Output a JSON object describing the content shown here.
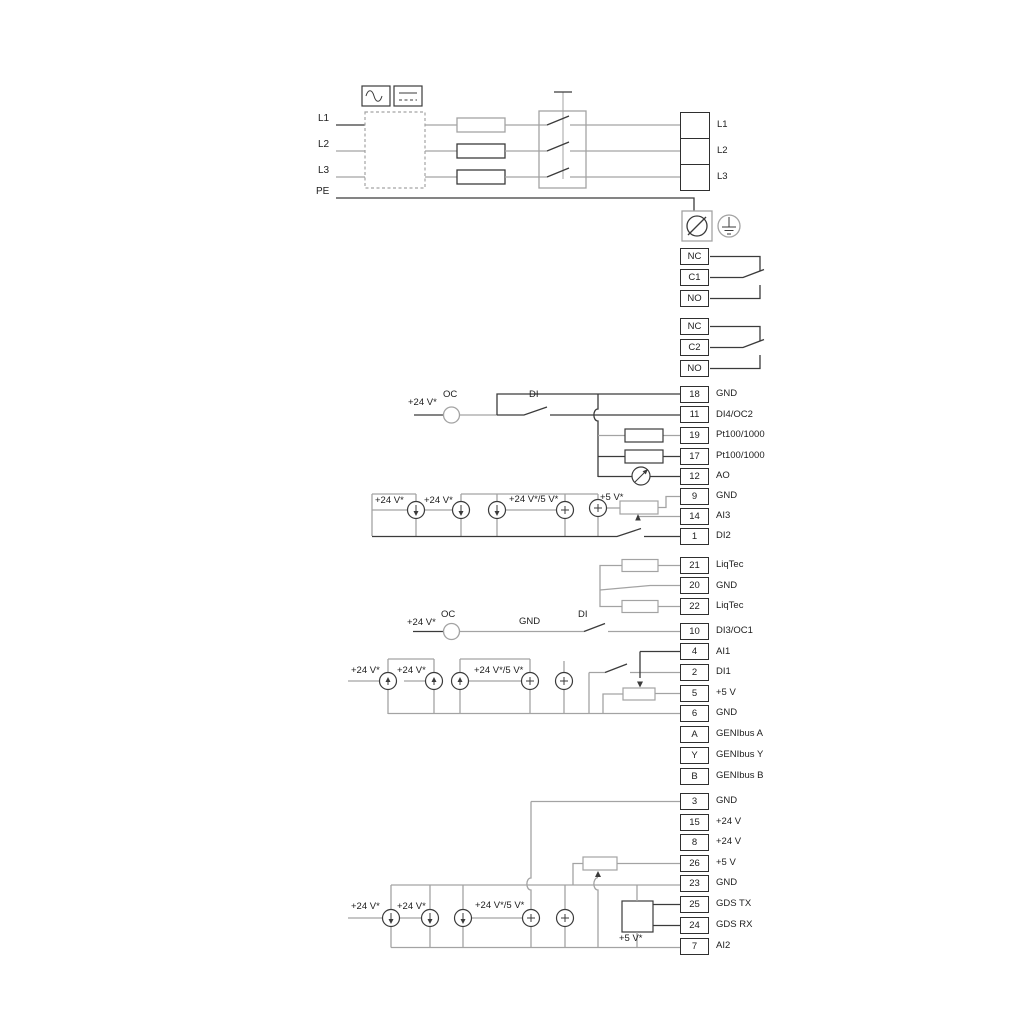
{
  "colors": {
    "background": "#ffffff",
    "wire_dark": "#3b3b3b",
    "wire_gray": "#a3a3a3",
    "text": "#1d1d1d"
  },
  "labels": {
    "v24": "+24 V*",
    "v24_5": "+24 V*/5 V*",
    "v5": "+5 V*",
    "oc": "OC",
    "di": "DI",
    "gnd": "GND"
  },
  "mains_left": [
    "L1",
    "L2",
    "L3",
    "PE"
  ],
  "mains_right": [
    "L1",
    "L2",
    "L3"
  ],
  "relay1": [
    "NC",
    "C1",
    "NO"
  ],
  "relay2": [
    "NC",
    "C2",
    "NO"
  ],
  "blocks": {
    "io1": [
      {
        "num": "18",
        "label": "GND"
      },
      {
        "num": "11",
        "label": "DI4/OC2"
      },
      {
        "num": "19",
        "label": "Pt100/1000"
      },
      {
        "num": "17",
        "label": "Pt100/1000"
      },
      {
        "num": "12",
        "label": "AO"
      },
      {
        "num": "9",
        "label": "GND"
      },
      {
        "num": "14",
        "label": "AI3"
      },
      {
        "num": "1",
        "label": "DI2"
      }
    ],
    "liqtec": [
      {
        "num": "21",
        "label": "LiqTec"
      },
      {
        "num": "20",
        "label": "GND"
      },
      {
        "num": "22",
        "label": "LiqTec"
      }
    ],
    "io2": [
      {
        "num": "10",
        "label": "DI3/OC1"
      },
      {
        "num": "4",
        "label": "AI1"
      },
      {
        "num": "2",
        "label": "DI1"
      },
      {
        "num": "5",
        "label": "+5 V"
      },
      {
        "num": "6",
        "label": "GND"
      },
      {
        "num": "A",
        "label": "GENIbus A"
      },
      {
        "num": "Y",
        "label": "GENIbus Y"
      },
      {
        "num": "B",
        "label": "GENIbus B"
      }
    ],
    "io3": [
      {
        "num": "3",
        "label": "GND"
      },
      {
        "num": "15",
        "label": "+24 V"
      },
      {
        "num": "8",
        "label": "+24 V"
      },
      {
        "num": "26",
        "label": "+5 V"
      },
      {
        "num": "23",
        "label": "GND"
      },
      {
        "num": "25",
        "label": "GDS TX"
      },
      {
        "num": "24",
        "label": "GDS RX"
      },
      {
        "num": "7",
        "label": "AI2"
      }
    ]
  }
}
